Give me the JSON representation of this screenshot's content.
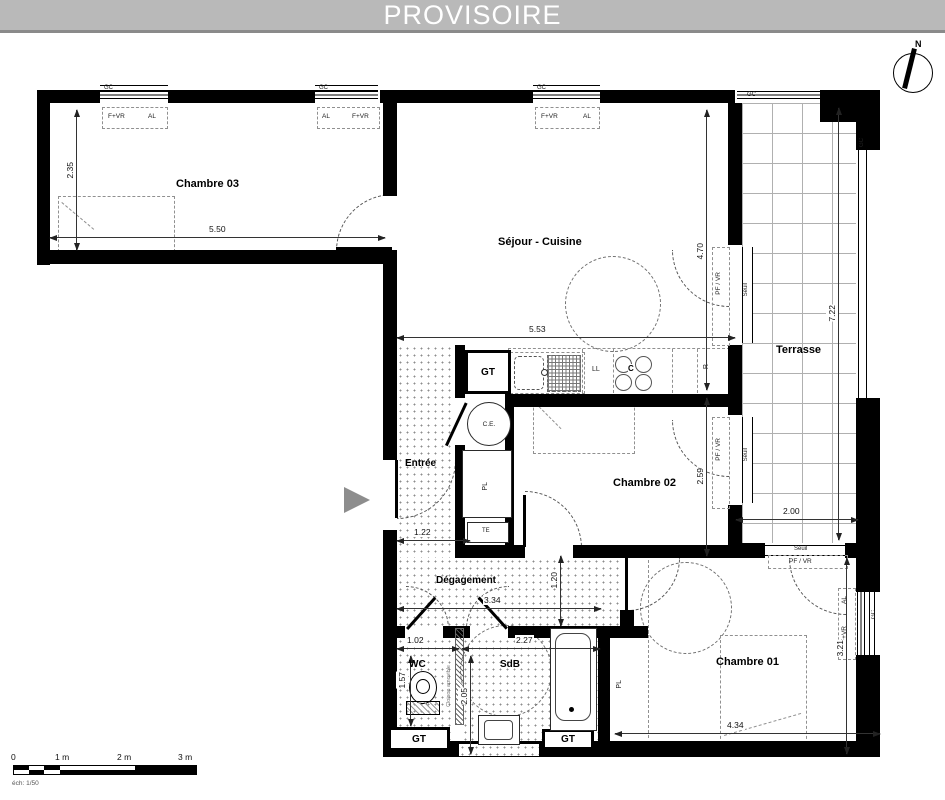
{
  "banner": {
    "title": "PROVISOIRE"
  },
  "compass": {
    "north": "N"
  },
  "rooms": {
    "chambre03": "Chambre 03",
    "sejour": "Séjour - Cuisine",
    "terrasse": "Terrasse",
    "chambre02": "Chambre 02",
    "chambre01": "Chambre 01",
    "entree": "Entrée",
    "degagement": "Dégagement",
    "wc": "WC",
    "sdb": "SdB"
  },
  "dims": {
    "ch03_w": "5.50",
    "ch03_h": "2.35",
    "sejour_w": "5.53",
    "sejour_h": "4.70",
    "ch02_h": "2.59",
    "terrasse_h": "7.22",
    "terrasse_w": "2.00",
    "entree_w": "1.22",
    "deg_w": "3.34",
    "deg_h": "1.20",
    "wc_w": "1.02",
    "wc_h": "1.57",
    "sdb_w": "2.27",
    "sdb_h": "2.05",
    "ch01_w": "4.34",
    "ch01_h": "3.21"
  },
  "ann": {
    "gt": "GT",
    "ce": "C.E.",
    "pl": "PL",
    "te": "TE",
    "ll": "LL",
    "c": "C",
    "r": "R",
    "seuil": "Seuil",
    "pf_vr": "PF / VR",
    "f_vr": "F+VR",
    "al": "AL",
    "gc": "GC",
    "cloison": "Cloison amovible"
  },
  "scalebar": {
    "t0": "0",
    "t1": "1 m",
    "t2": "2 m",
    "t3": "3 m",
    "ech": "éch: 1/50"
  },
  "colors": {
    "banner_bg": "#b9b9b9",
    "banner_border": "#8a8a8a",
    "wall": "#000000",
    "entrance_arrow": "#8d8d8d"
  }
}
